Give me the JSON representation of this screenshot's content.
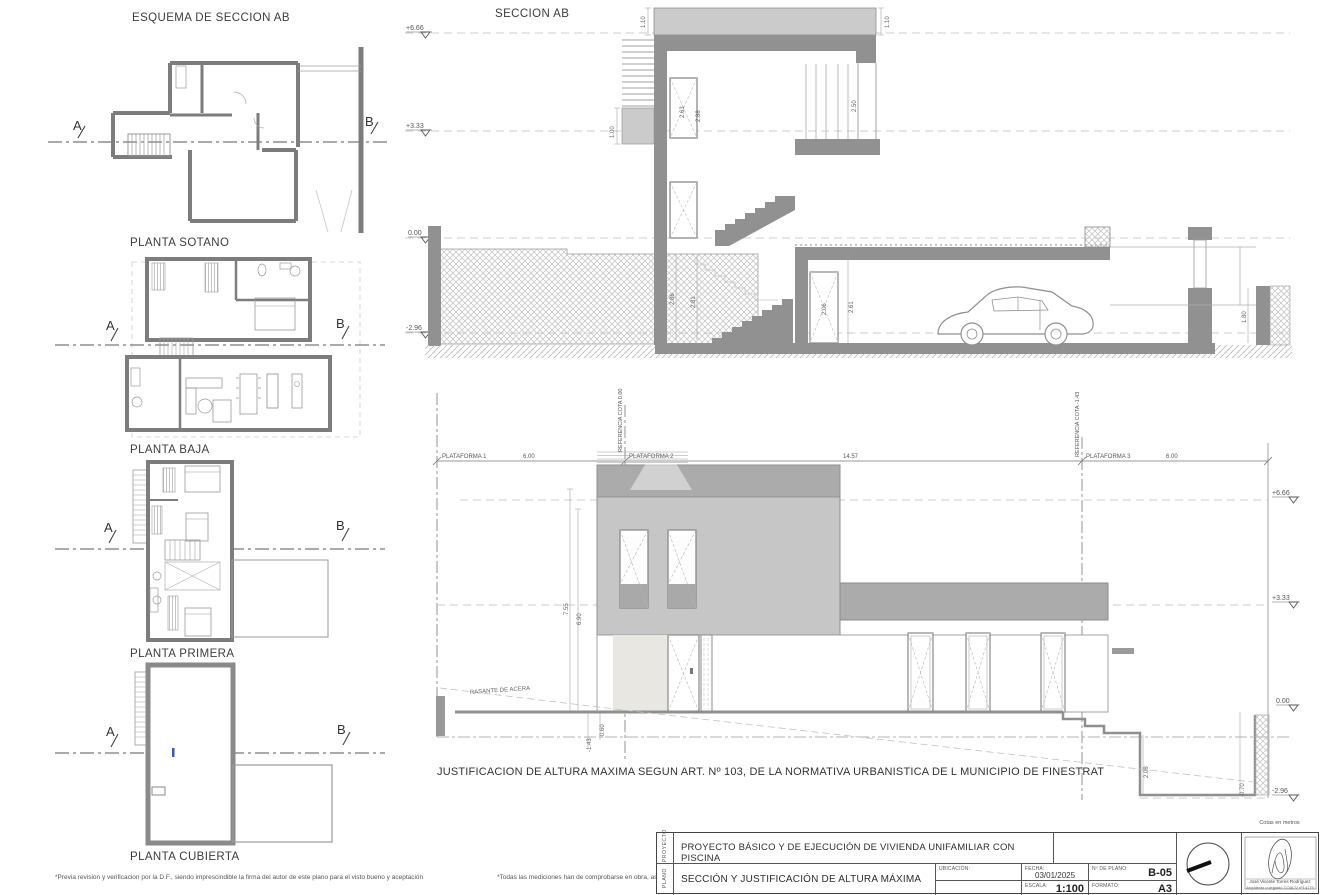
{
  "sheet": {
    "plans_title": "ESQUEMA DE SECCION AB",
    "footnote_left": "*Previa revision y verificacion por la D.F., siendo imprescindible la firma del autor de este plano para el visto bueno y aceptación",
    "footnote_right": "*Todas las mediciones han de comprobarse en obra, así como las posibles modificaciones"
  },
  "plans": {
    "marker_a": "A",
    "marker_b": "B",
    "labels": [
      "PLANTA SOTANO",
      "PLANTA BAJA",
      "PLANTA PRIMERA",
      "PLANTA CUBIERTA"
    ]
  },
  "section": {
    "title": "SECCION AB",
    "levels": [
      "+6.66",
      "+3.33",
      "0.00",
      "-2.96"
    ],
    "dims": {
      "parapet_left": "1.10",
      "parapet_right": "1.10",
      "roof_access": "1.00",
      "window_a": "2.63",
      "window_b": "2.88",
      "railing": "2.50",
      "stair_a": "2.86",
      "stair_b": "2.81",
      "door_a": "2.06",
      "door_b": "2.61",
      "ramp": "1.80"
    }
  },
  "elevation": {
    "caption": "JUSTIFICACION DE ALTURA MAXIMA SEGUN ART. Nº 103, DE LA NORMATIVA URBANISTICA DE L MUNICIPIO DE FINESTRAT",
    "plataforma_1": "PLATAFORMA 1",
    "plataforma_2": "PLATAFORMA 2",
    "plataforma_3": "PLATAFORMA 3",
    "ref_cota_0": "REFERENCIA COTA 0.00",
    "ref_cota_neg": "REFERENCIA COTA -1.43",
    "dist_left": "6.00",
    "dist_mid": "14.57",
    "dist_right": "6.00",
    "rasante": "RASANTE DE ACERA",
    "levels": [
      "+6.66",
      "+3.33",
      "0.00",
      "-2.96"
    ],
    "dims": {
      "total_height": "7.55",
      "building_height": "6.90",
      "acera_offset": "-0.60",
      "ref_offset": "-1.43",
      "pit_height": "2.08",
      "pit_offset": "-0.70"
    }
  },
  "titleblock": {
    "row_label_project": "PROYECTO",
    "row_label_plan": "PLANO",
    "project_title": "PROYECTO BÁSICO Y DE EJECUCIÓN DE  VIVIENDA UNIFAMILIAR CON PISCINA",
    "plan_title": "SECCIÓN Y JUSTIFICACIÓN DE ALTURA MÁXIMA",
    "ubicacion_label": "UBICACIÓN:",
    "fecha_label": "FECHA:",
    "fecha_value": "03/01/2025",
    "num_plano_label": "Nº DE PLANO:",
    "num_plano_value": "B-05",
    "escala_label": "ESCALA:",
    "escala_value": "1:100",
    "formato_label": "FORMATO:",
    "formato_value": "A3",
    "units_note": "Cotas en metros",
    "author_name": "José Vicente Torres Rodríguez",
    "author_credentials": "Arquitecto colegiado COACV nº14179"
  }
}
